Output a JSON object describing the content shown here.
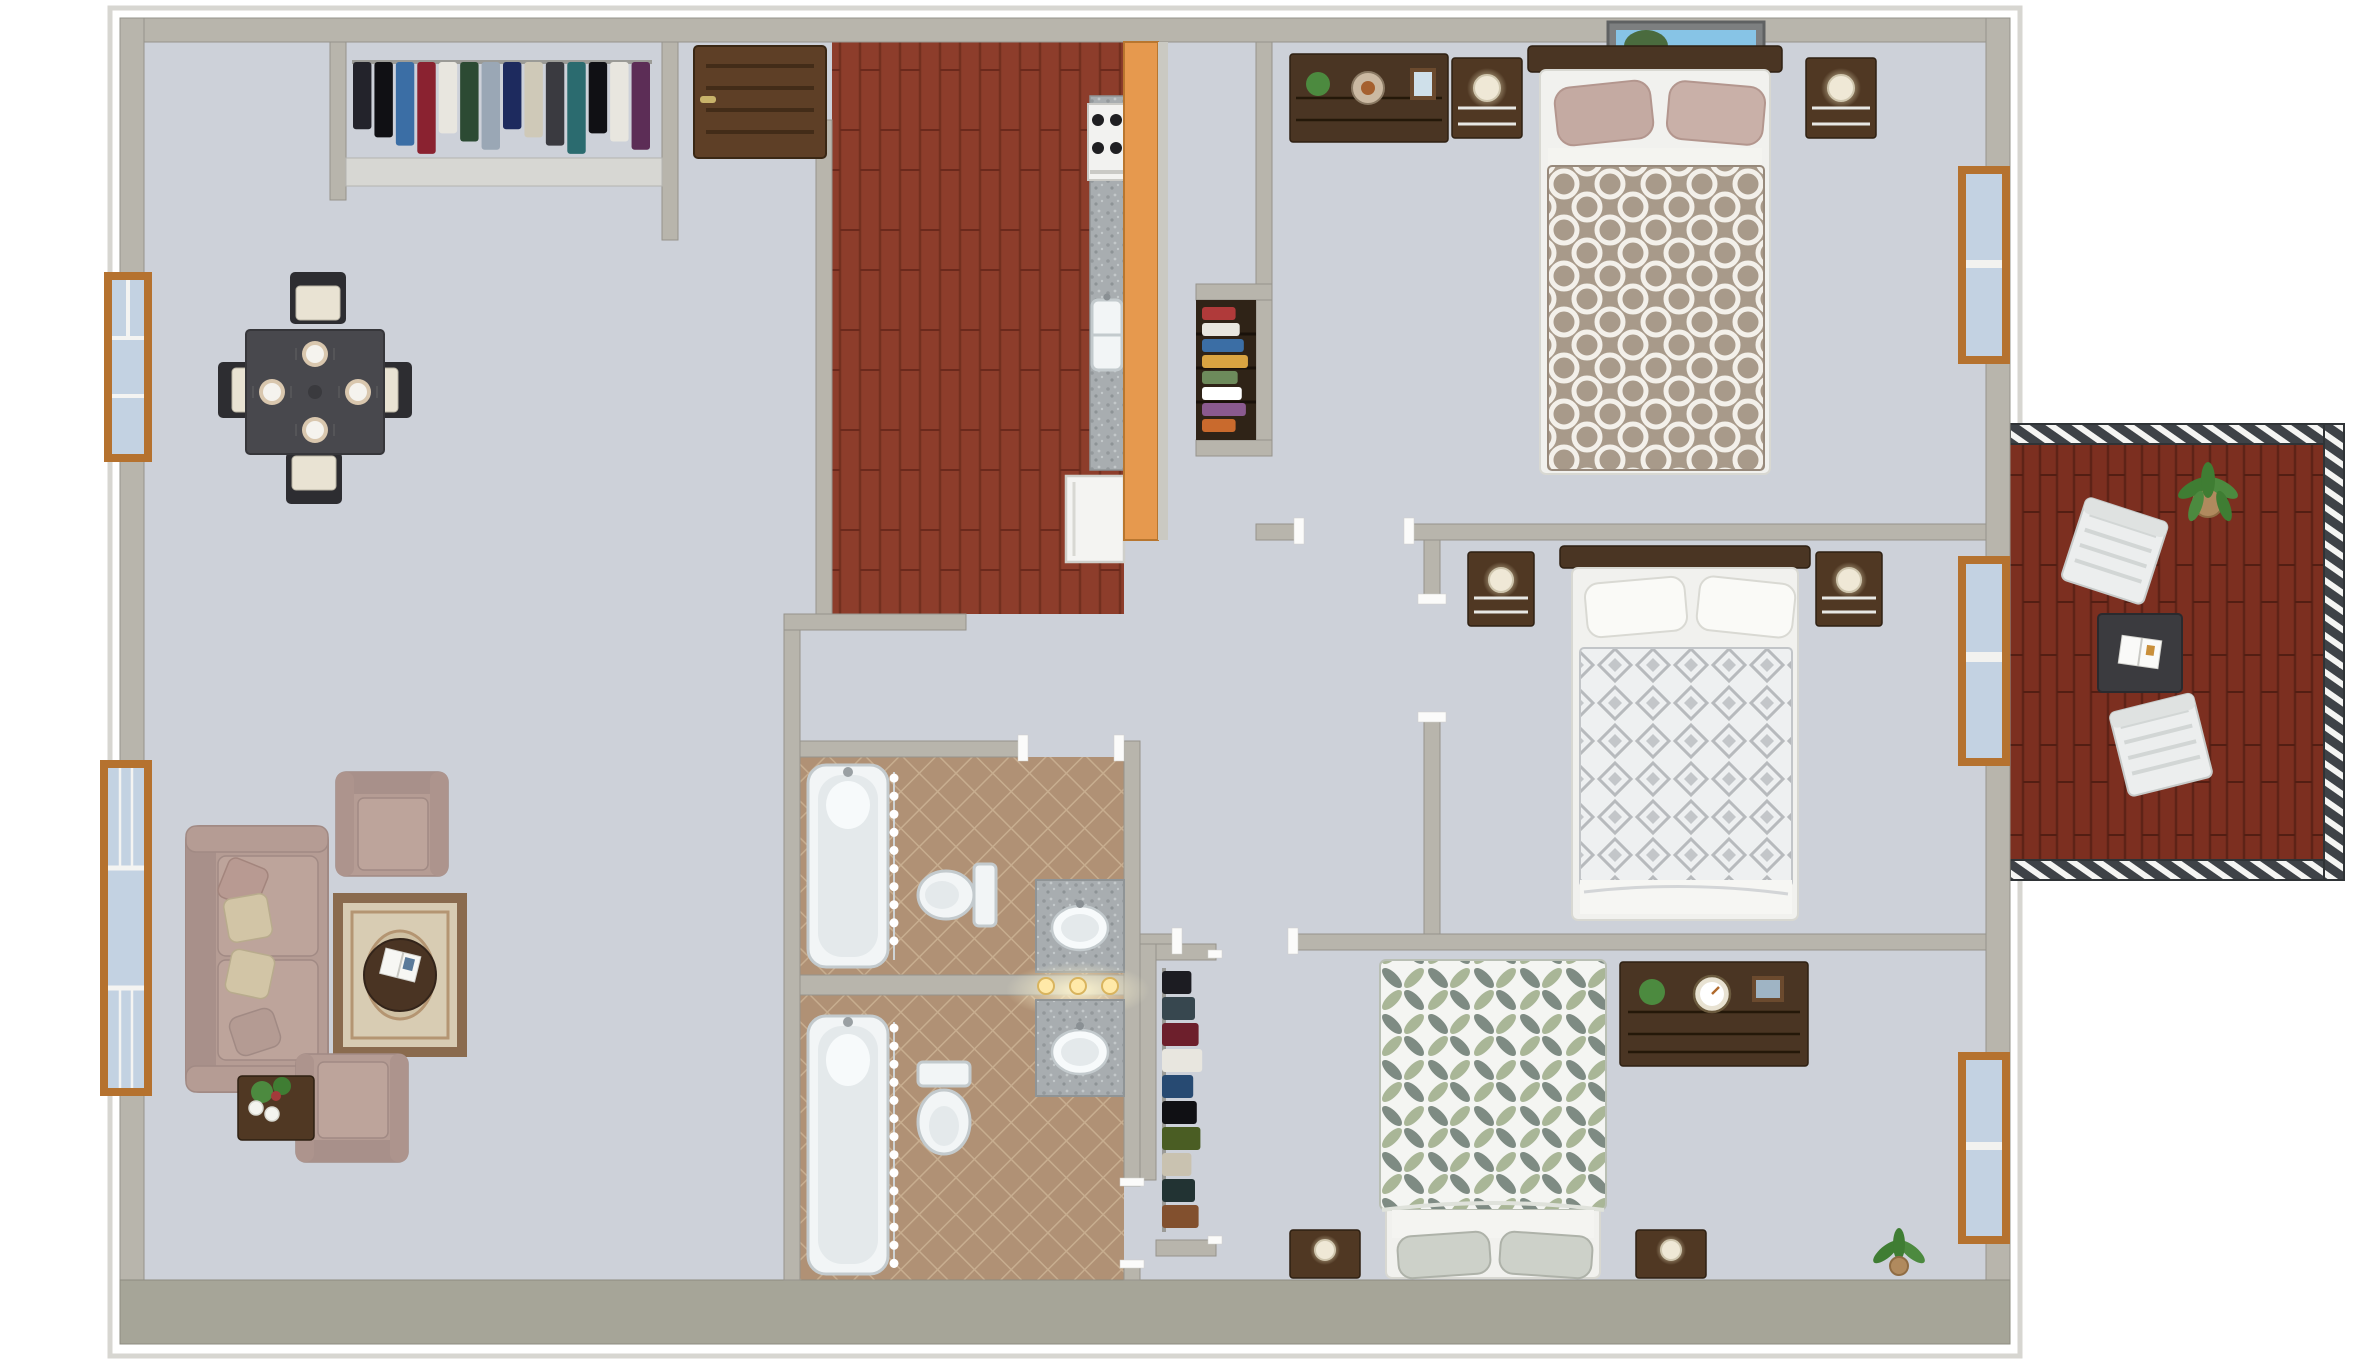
{
  "scene": {
    "kind": "3d-floor-plan-render",
    "view": "top-down",
    "background": "#ffffff",
    "rooms_visible": [
      "entry",
      "entry-closet",
      "dining-area",
      "living-room",
      "kitchen",
      "hallway",
      "pantry-closet",
      "bathroom-1",
      "bathroom-2",
      "bedroom-1",
      "bedroom-2",
      "bedroom-3",
      "bedroom-3-closet",
      "balcony"
    ]
  },
  "colors": {
    "wall": "#b8b5ac",
    "wall-dark": "#a6a598",
    "carpet": "#cdd1d9",
    "shelf": "#d7d7d3",
    "jamb": "#fbfbfa",
    "bar": "#e6994e",
    "counter-sliver": "#cac9c2",
    "door": "#5e3f26",
    "door-panel": "#432c18",
    "handle": "#c9b36a",
    "frame": "#b5722f",
    "glass": "#c3d2e2",
    "sofa": "#b59c94",
    "cushion": "#bda49b",
    "pillow-tan": "#d2c5a6",
    "pillow-rose": "#b89a92",
    "rug": "#d8ccb3",
    "rug-border": "#8a6b4e",
    "rug-line": "#b49572",
    "ottoman": "#4a3423",
    "table-dark": "#48484d",
    "chair-black": "#2d2d31",
    "seat-cream": "#e9e3d3",
    "plate": "#f5f3ee",
    "charger": "#d9c7ae",
    "wood-dark": "#4a3523",
    "wood-mid": "#503823",
    "mattress": "#f1f1ee",
    "sheet": "#f5f5f1",
    "pillow-mauve": "#c4aaa2",
    "pillow-white": "#fafaf7",
    "pillow-knit": "#cdd1c9",
    "fixture": "#f2f5f6",
    "fixture-stroke": "#c3cacd",
    "fixture-inner": "#e4e9eb",
    "glow": "#ffe9a8",
    "lamp": "#efe8d6",
    "plant": "#4c8a3f",
    "plant-dark": "#3f7d33",
    "pot": "#b08a5e",
    "railing": "#3e4247",
    "deck-table": "#3b3b3f",
    "deck-chair": "#eceeee",
    "art-sky": "#87c4e6",
    "art-sea": "#2f93ac",
    "art-sand": "#e7d6a4",
    "art-cliff": "#4a6b3e",
    "art-frame": "#7d7f80"
  },
  "closets": {
    "entry": [
      "#23232b",
      "#101014",
      "#3b6ea5",
      "#8a2230",
      "#e8e6df",
      "#2c4a33",
      "#9aa7b5",
      "#1d2a5e",
      "#cfc9b8",
      "#3a3a40",
      "#2b6b6f",
      "#101014",
      "#e8e6df",
      "#5c2d56"
    ],
    "bedroom3": [
      "#1c1c22",
      "#37474f",
      "#6d1f2c",
      "#e8e6df",
      "#274a72",
      "#101014",
      "#4a5d23",
      "#c9c2b0",
      "#223333",
      "#82502e"
    ],
    "pantry": [
      "#b03a3a",
      "#e8e6df",
      "#3b6ea5",
      "#d9a441",
      "#6d8a5b",
      "#ffffff",
      "#8a5a8f",
      "#c96a2d"
    ]
  },
  "rooms": [
    {
      "name": "entry",
      "floor": "carpet",
      "features": [
        "front-door"
      ]
    },
    {
      "name": "entry-closet",
      "floor": "carpet",
      "features": [
        "hanging-clothes",
        "shelf-header"
      ]
    },
    {
      "name": "dining-area",
      "floor": "carpet",
      "furniture": [
        "dining-table",
        "dining-chair-north",
        "dining-chair-west",
        "dining-chair-east",
        "dining-chair-south",
        "four-place-settings"
      ]
    },
    {
      "name": "living-room",
      "floor": "carpet",
      "furniture": [
        "sofa",
        "armchair-upper",
        "armchair-lower",
        "side-table-with-calla-lilies",
        "area-rug",
        "round-ottoman-with-magazine"
      ],
      "windows": [
        "living-window"
      ]
    },
    {
      "name": "kitchen",
      "floor": "hardwood",
      "furniture": [
        "range-stove",
        "granite-counter",
        "double-sink",
        "refrigerator",
        "breakfast-bar"
      ]
    },
    {
      "name": "hallway",
      "floor": "carpet",
      "features": [
        "door-openings-with-white-jambs"
      ]
    },
    {
      "name": "pantry-closet",
      "floor": "carpet",
      "features": [
        "shelves-with-linens"
      ]
    },
    {
      "name": "bathroom-1",
      "floor": "tan-tile",
      "fixtures": [
        "bathtub-with-curtain",
        "toilet",
        "granite-vanity-sink"
      ]
    },
    {
      "name": "bathroom-2",
      "floor": "tan-tile",
      "fixtures": [
        "bathtub-with-curtain",
        "toilet",
        "granite-vanity-sink",
        "vanity-light-bar"
      ]
    },
    {
      "name": "bedroom-1",
      "floor": "carpet",
      "furniture": [
        "bed-quatrefoil-duvet",
        "nightstand-left",
        "nightstand-right",
        "table-lamp-x2",
        "dresser-with-plant-and-fishbowl",
        "beach-artwork"
      ],
      "windows": [
        "bedroom1-window"
      ]
    },
    {
      "name": "bedroom-2",
      "floor": "carpet",
      "furniture": [
        "bed-diamond-duvet",
        "nightstand-left",
        "nightstand-right",
        "table-lamp-x2"
      ],
      "windows": [
        "balcony-sliding-door"
      ]
    },
    {
      "name": "bedroom-3",
      "floor": "carpet",
      "furniture": [
        "bed-petal-duvet",
        "nightstand-left",
        "nightstand-right",
        "dresser-with-plant-clock-frame",
        "floor-plant"
      ],
      "windows": [
        "bedroom3-window"
      ]
    },
    {
      "name": "bedroom-3-closet",
      "floor": "carpet",
      "features": [
        "hanging-clothes"
      ]
    },
    {
      "name": "balcony",
      "floor": "dark-hardwood-deck",
      "furniture": [
        "patio-chair-upper",
        "patio-table-with-magazine",
        "patio-chair-lower",
        "potted-plant"
      ],
      "features": [
        "slatted-railing"
      ]
    }
  ],
  "windows": [
    {
      "name": "dining-window",
      "wall": "left"
    },
    {
      "name": "living-window",
      "wall": "left"
    },
    {
      "name": "bedroom1-window",
      "wall": "right"
    },
    {
      "name": "balcony-sliding-door",
      "wall": "right"
    },
    {
      "name": "bedroom3-window",
      "wall": "right"
    }
  ]
}
